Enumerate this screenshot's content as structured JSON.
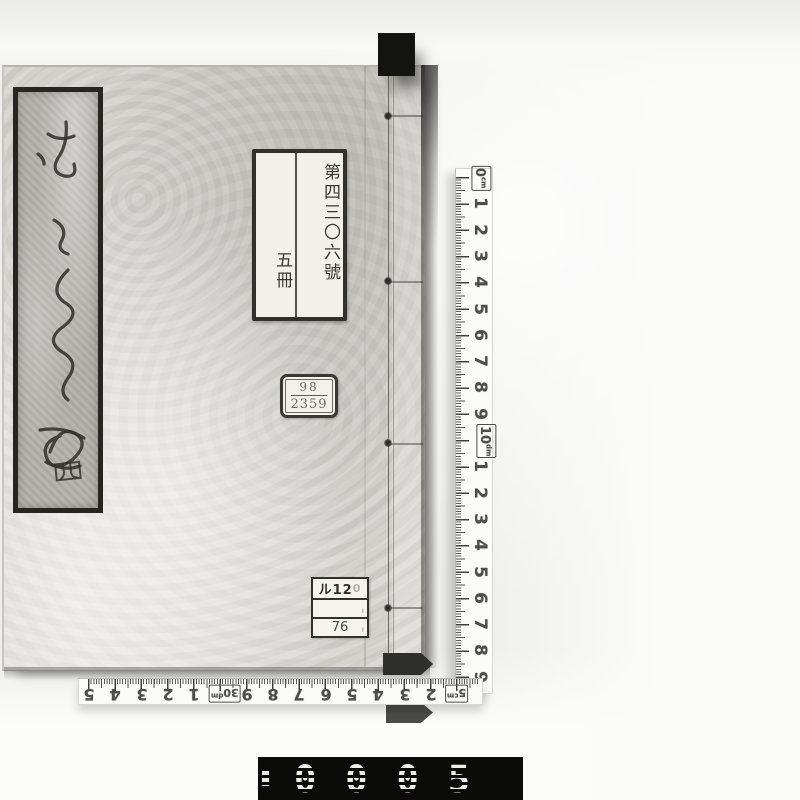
{
  "scene": {
    "description": "Black-and-white archival photograph of a traditional Japanese stab-bound book photographed with cm rulers and a frame counter"
  },
  "book": {
    "title_slip": {
      "calligraphy_note": "cursive handwritten kana title (illegible)",
      "volume_character": "四"
    },
    "call_number_label": {
      "line1": "第四三〇六號",
      "line2": "五冊"
    },
    "stamp_label": {
      "top": "98",
      "bottom": "2359"
    },
    "shelf_label": {
      "row1": "ル12",
      "row1_faint": "0",
      "row2": "",
      "row3": "76"
    }
  },
  "rulers": {
    "vertical": {
      "unit": "cm",
      "marks": [
        {
          "t": "0",
          "sub": "cm",
          "box": true
        },
        {
          "t": "1"
        },
        {
          "t": "2"
        },
        {
          "t": "3"
        },
        {
          "t": "4"
        },
        {
          "t": "5"
        },
        {
          "t": "6"
        },
        {
          "t": "7"
        },
        {
          "t": "8"
        },
        {
          "t": "9"
        },
        {
          "t": "10",
          "sub": "dm",
          "box": true
        },
        {
          "t": "1"
        },
        {
          "t": "2"
        },
        {
          "t": "3"
        },
        {
          "t": "4"
        },
        {
          "t": "5"
        },
        {
          "t": "6"
        },
        {
          "t": "7"
        },
        {
          "t": "8"
        },
        {
          "t": "9"
        }
      ]
    },
    "horizontal": {
      "unit": "cm",
      "orientation_note": "numbers printed upside-down",
      "marks": [
        {
          "t": "5"
        },
        {
          "t": "4"
        },
        {
          "t": "3"
        },
        {
          "t": "2"
        },
        {
          "t": "1"
        },
        {
          "t": "30",
          "sub": "dm",
          "box": true
        },
        {
          "t": "9"
        },
        {
          "t": "8"
        },
        {
          "t": "7"
        },
        {
          "t": "6"
        },
        {
          "t": "5"
        },
        {
          "t": "4"
        },
        {
          "t": "3"
        },
        {
          "t": "2"
        },
        {
          "t": "5",
          "sub": "cm",
          "box": true
        }
      ]
    }
  },
  "counter": {
    "digits": "0005"
  },
  "colors": {
    "background": "#eeeeec",
    "cover": "#d7d5d0",
    "slip": "#b3b1ab",
    "label_bg": "#f2f0e9",
    "border_dark": "#262521",
    "tab_black": "#131312",
    "ruler_bg": "#fbfbf9",
    "counter_bg": "#0b0b0a",
    "counter_digits": "#f0f0e8"
  }
}
